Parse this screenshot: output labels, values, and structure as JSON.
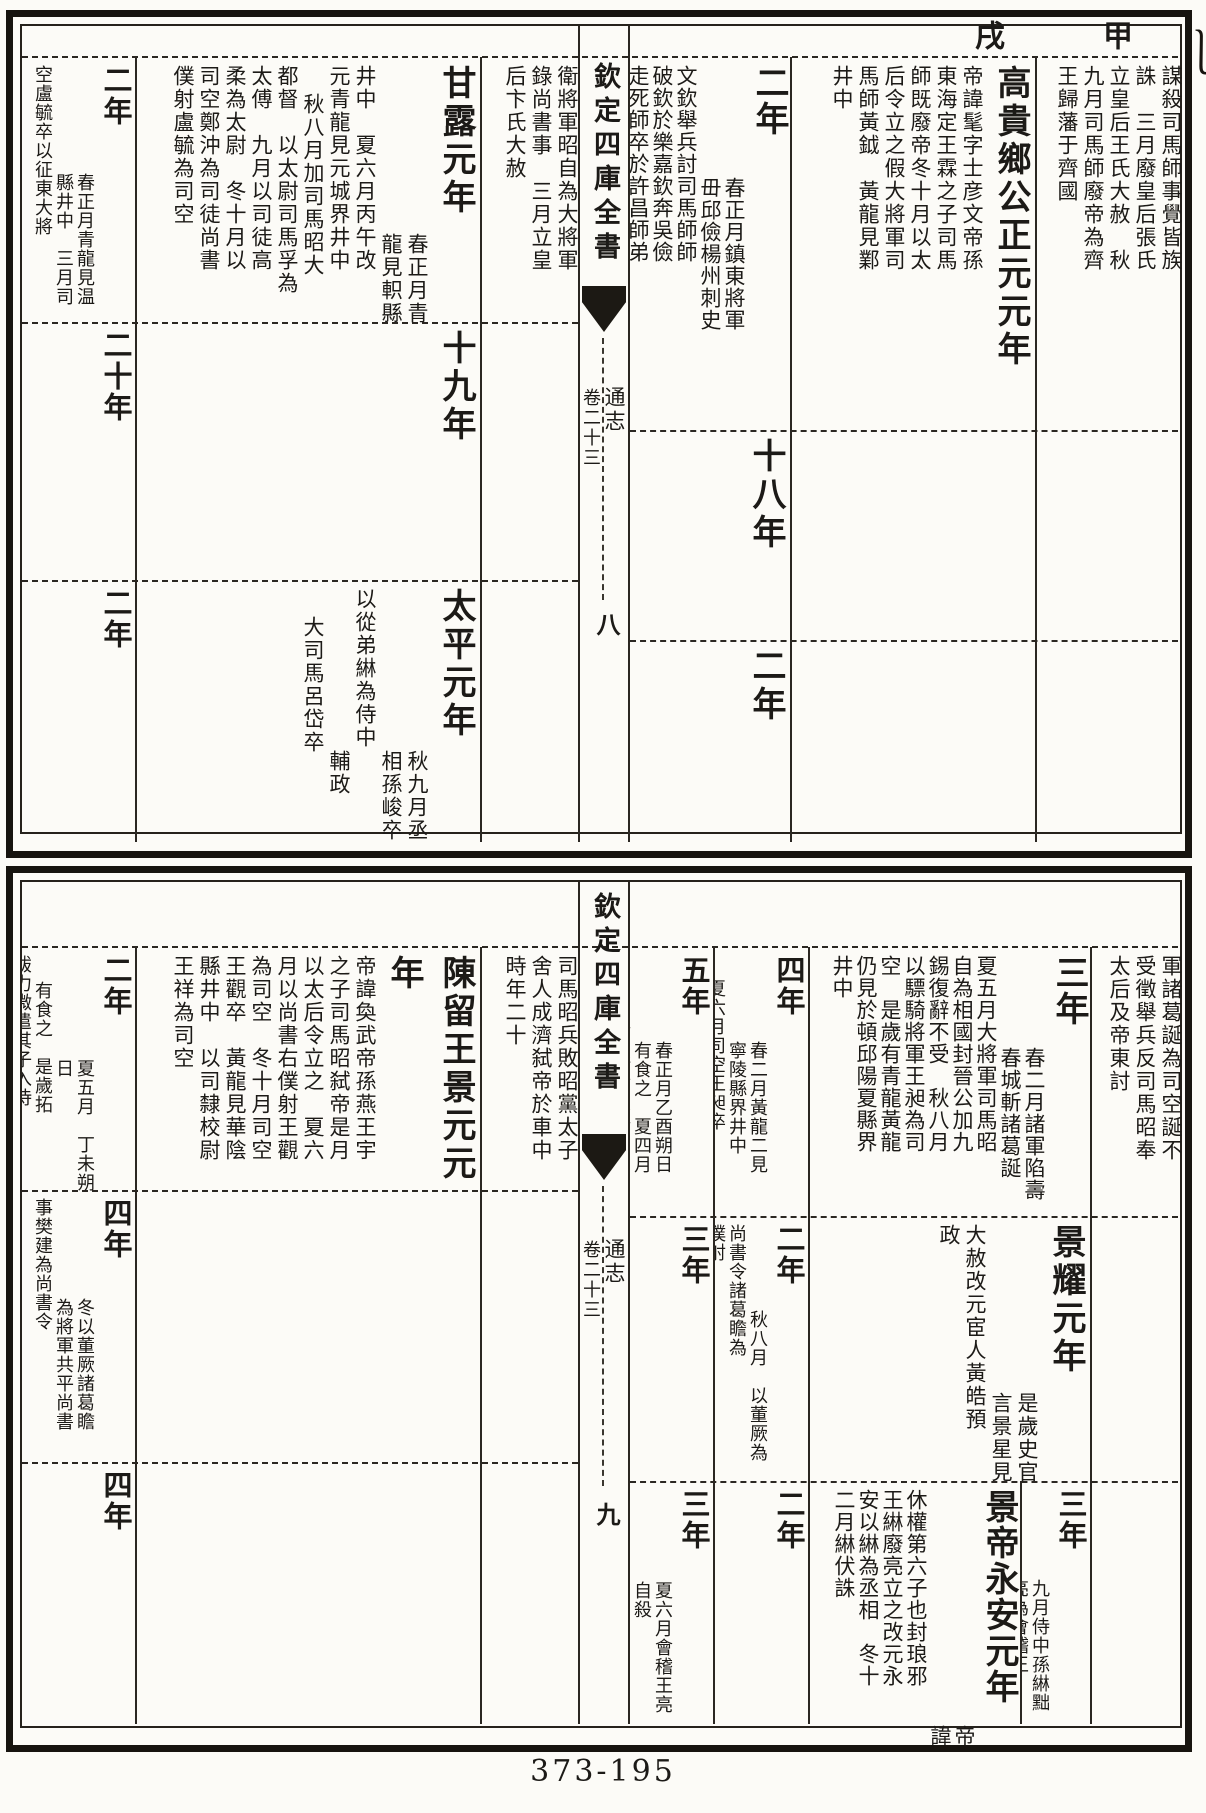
{
  "page": {
    "footer": "373-195",
    "ganzhi_right": "甲",
    "ganzhi_left": "戌"
  },
  "strip": {
    "title": "欽定四庫全書",
    "book": "通志",
    "juan": "卷二十三",
    "page_top": "八",
    "page_bottom": "九"
  },
  "blocks": [
    {
      "cells": [
        {
          "key": "jiaping-continuation",
          "cols": [
            {
              "s": "謀殺司馬師事覺皆族",
              "t": "S"
            },
            {
              "s": "誅　三月廢皇后張氏",
              "t": "S"
            },
            {
              "s": "立皇后王氏大赦　秋",
              "t": "S"
            },
            {
              "s": "九月司馬師廢帝為齊",
              "t": "S"
            },
            {
              "s": "王歸藩于齊國",
              "t": "S"
            }
          ]
        },
        {
          "key": "zhengyuan-1",
          "cols": [
            {
              "s": "高貴鄉公正元元年",
              "t": "L"
            },
            {
              "s": "帝諱髦字士彦文帝孫",
              "t": "S"
            },
            {
              "s": "東海定王霖之子司馬",
              "t": "S"
            },
            {
              "s": "師既廢帝冬十月以太",
              "t": "S"
            },
            {
              "s": "后令立之假大將軍司",
              "t": "S"
            },
            {
              "s": "馬師黃鉞　黃龍見鄴",
              "t": "S"
            },
            {
              "s": "井中",
              "t": "S"
            }
          ]
        },
        {
          "key": "zhengyuan-2",
          "cols": [
            {
              "s": "二年",
              "t": "L"
            },
            {
              "s": "春正月鎮東將軍",
              "t": "S",
              "pad": 112
            },
            {
              "s": "毌邱儉楊州刺史",
              "t": "S",
              "pad": 112
            },
            {
              "s": "文欽舉兵討司馬師師",
              "t": "S"
            },
            {
              "s": "破欽於樂嘉欽奔吳儉",
              "t": "S"
            },
            {
              "s": "走死師卒於許昌師弟",
              "t": "S"
            }
          ]
        },
        {
          "key": "zhengyuan-2-continuation",
          "cols": [
            {
              "s": "衛將軍昭自為大將軍",
              "t": "S"
            },
            {
              "s": "錄尚書事　三月立皇",
              "t": "S"
            },
            {
              "s": "后卞氏大赦",
              "t": "S"
            }
          ]
        },
        {
          "key": "ganlu-1",
          "cols": [
            {
              "s": "甘露元年",
              "t": "L"
            },
            {
              "s": "春正月青",
              "t": "S",
              "pad": 168
            },
            {
              "s": "龍見軹縣",
              "t": "S",
              "pad": 168
            },
            {
              "s": "井中　夏六月丙午改",
              "t": "S"
            },
            {
              "s": "元青龍見元城界井中",
              "t": "S"
            },
            {
              "s": "秋八月加司馬昭大",
              "t": "S",
              "pad": 28
            },
            {
              "s": "都督　以太尉司馬孚為",
              "t": "S"
            },
            {
              "s": "太傅　九月以司徒高",
              "t": "S"
            },
            {
              "s": "柔為太尉　冬十月以",
              "t": "S"
            },
            {
              "s": "司空鄭沖為司徒尚書",
              "t": "S"
            },
            {
              "s": "僕射盧毓為司空",
              "t": "S"
            }
          ]
        },
        {
          "key": "ganlu-2",
          "cols": [
            {
              "s": "二年",
              "t": "L"
            },
            {
              "s": "春正月青龍見温",
              "t": "S",
              "pad": 108
            },
            {
              "s": "縣井中　三月司",
              "t": "S",
              "pad": 108
            },
            {
              "s": "空盧毓卒以征東大將",
              "t": "S"
            }
          ]
        },
        {
          "key": "yanxi-18",
          "cols": [
            {
              "s": "十八年",
              "t": "L"
            }
          ]
        },
        {
          "key": "yanxi-19",
          "cols": [
            {
              "s": "十九年",
              "t": "L"
            }
          ]
        },
        {
          "key": "yanxi-20",
          "cols": [
            {
              "s": "二十年",
              "t": "L"
            }
          ]
        },
        {
          "key": "wufeng-2",
          "cols": [
            {
              "s": "二年",
              "t": "L"
            }
          ]
        },
        {
          "key": "taiping-1",
          "cols": [
            {
              "s": "太平元年",
              "t": "L"
            },
            {
              "s": "秋九月丞",
              "t": "S",
              "pad": 162
            },
            {
              "s": "相孫峻卒",
              "t": "S",
              "pad": 162
            },
            {
              "s": "以從弟綝為侍中",
              "t": "S"
            },
            {
              "s": "輔政",
              "t": "S",
              "pad": 162
            },
            {
              "s": "大司馬呂岱卒",
              "t": "S",
              "pad": 28
            }
          ]
        },
        {
          "key": "taiping-2",
          "cols": [
            {
              "s": "二年",
              "t": "L"
            }
          ]
        }
      ]
    },
    {
      "cells": [
        {
          "key": "ganlu-2-continuation",
          "cols": [
            {
              "s": "軍諸葛誕為司空誕不",
              "t": "S"
            },
            {
              "s": "受徵舉兵反司馬昭奉",
              "t": "S"
            },
            {
              "s": "太后及帝東討",
              "t": "S"
            }
          ]
        },
        {
          "key": "ganlu-3",
          "cols": [
            {
              "s": "三年",
              "t": "L"
            },
            {
              "s": "春二月諸軍陷壽",
              "t": "S",
              "pad": 92
            },
            {
              "s": "春城斬諸葛誕",
              "t": "S",
              "pad": 92
            },
            {
              "s": "夏五月大將軍司馬昭",
              "t": "S"
            },
            {
              "s": "自為相國封晉公加九",
              "t": "S"
            },
            {
              "s": "錫復辭不受　秋八月",
              "t": "S"
            },
            {
              "s": "以驃騎將軍王昶為司",
              "t": "S"
            },
            {
              "s": "空　是歲有青龍黃龍",
              "t": "S"
            },
            {
              "s": "仍見於頓邱陽夏縣界",
              "t": "S"
            },
            {
              "s": "井中",
              "t": "S"
            }
          ]
        },
        {
          "key": "ganlu-4",
          "cols": [
            {
              "s": "四年",
              "t": "L"
            },
            {
              "s": "春二月黃龍二見",
              "t": "S",
              "pad": 86
            },
            {
              "s": "寧陵縣界井中",
              "t": "S",
              "pad": 86
            },
            {
              "s": "夏六月司空王昶卒",
              "t": "S",
              "pad": 24
            }
          ]
        },
        {
          "key": "ganlu-5",
          "cols": [
            {
              "s": "五年",
              "t": "L"
            },
            {
              "s": "春正月乙酉朔日",
              "t": "S",
              "pad": 86
            },
            {
              "s": "有食之　夏四月",
              "t": "S",
              "pad": 86
            },
            {
              "s": "帝自將宿衛討大將軍",
              "t": "S",
              "pad": 24
            }
          ]
        },
        {
          "key": "ganlu-5-continuation",
          "cols": [
            {
              "s": "司馬昭兵敗昭黨太子",
              "t": "S"
            },
            {
              "s": "舍人成濟弑帝於車中",
              "t": "S"
            },
            {
              "s": "時年二十",
              "t": "S"
            }
          ]
        },
        {
          "key": "jingyuan-1",
          "cols": [
            {
              "s": "陳留王景元元年",
              "t": "L"
            },
            {
              "s": "帝諱奐武帝孫燕王宇",
              "t": "S"
            },
            {
              "s": "之子司馬昭弑帝是月",
              "t": "S"
            },
            {
              "s": "以太后令立之　夏六",
              "t": "S"
            },
            {
              "s": "月以尚書右僕射王觀",
              "t": "S"
            },
            {
              "s": "為司空　冬十月司空",
              "t": "S"
            },
            {
              "s": "王觀卒　黃龍見華陰",
              "t": "S"
            },
            {
              "s": "縣井中　以司隸校尉",
              "t": "S"
            },
            {
              "s": "王祥為司空",
              "t": "S"
            }
          ]
        },
        {
          "key": "jingyuan-2",
          "cols": [
            {
              "s": "二年",
              "t": "L"
            },
            {
              "s": "夏五月　丁未朔日",
              "t": "S",
              "pad": 104
            },
            {
              "s": "有食之　是歲拓",
              "t": "S",
              "pad": 26
            },
            {
              "s": "跋力微遣其子入侍",
              "t": "S"
            }
          ]
        },
        {
          "key": "jingyao-1",
          "cols": [
            {
              "s": "景耀元年",
              "t": "L"
            },
            {
              "s": "是歲史官",
              "t": "S",
              "pad": 168
            },
            {
              "s": "言景星見",
              "t": "S",
              "pad": 168
            },
            {
              "s": "大赦改元宦人黃皓預",
              "t": "S"
            },
            {
              "s": "政",
              "t": "S"
            }
          ]
        },
        {
          "key": "jingyao-2",
          "cols": [
            {
              "s": "二年",
              "t": "L"
            },
            {
              "s": "秋八月　以董厥為",
              "t": "S",
              "pad": 86
            },
            {
              "s": "尚書令諸葛瞻為",
              "t": "S"
            },
            {
              "s": "僕射",
              "t": "S"
            }
          ]
        },
        {
          "key": "jingyao-3",
          "cols": [
            {
              "s": "三年",
              "t": "L"
            }
          ]
        },
        {
          "key": "jingyao-4",
          "cols": [
            {
              "s": "四年",
              "t": "L"
            },
            {
              "s": "冬以董厥諸葛瞻",
              "t": "S",
              "pad": 100
            },
            {
              "s": "為將軍共平尚書",
              "t": "S",
              "pad": 100
            },
            {
              "s": "事樊建為尚書令",
              "t": "S"
            }
          ]
        },
        {
          "key": "taiping-3",
          "cols": [
            {
              "s": "三年",
              "t": "L"
            },
            {
              "s": "九月侍中孫綝黜",
              "t": "S",
              "pad": 90
            },
            {
              "s": "亮為會稽王",
              "t": "S",
              "pad": 90
            }
          ]
        },
        {
          "key": "yongan-1",
          "cols": [
            {
              "s": "景帝永安元年",
              "t": "L"
            },
            {
              "s": "帝諱",
              "t": "S",
              "pad": 236
            },
            {
              "s": "休權第六子也封琅邪",
              "t": "S"
            },
            {
              "s": "王綝廢亮立之改元永",
              "t": "S"
            },
            {
              "s": "安以綝為丞相　冬十",
              "t": "S"
            },
            {
              "s": "二月綝伏誅",
              "t": "S"
            }
          ]
        },
        {
          "key": "yongan-2",
          "cols": [
            {
              "s": "二年",
              "t": "L"
            }
          ]
        },
        {
          "key": "yongan-3",
          "cols": [
            {
              "s": "三年",
              "t": "L"
            },
            {
              "s": "夏六月會稽王亮",
              "t": "S",
              "pad": 92
            },
            {
              "s": "自殺",
              "t": "S",
              "pad": 92
            }
          ]
        },
        {
          "key": "yongan-4",
          "cols": [
            {
              "s": "四年",
              "t": "L"
            }
          ]
        }
      ]
    }
  ]
}
